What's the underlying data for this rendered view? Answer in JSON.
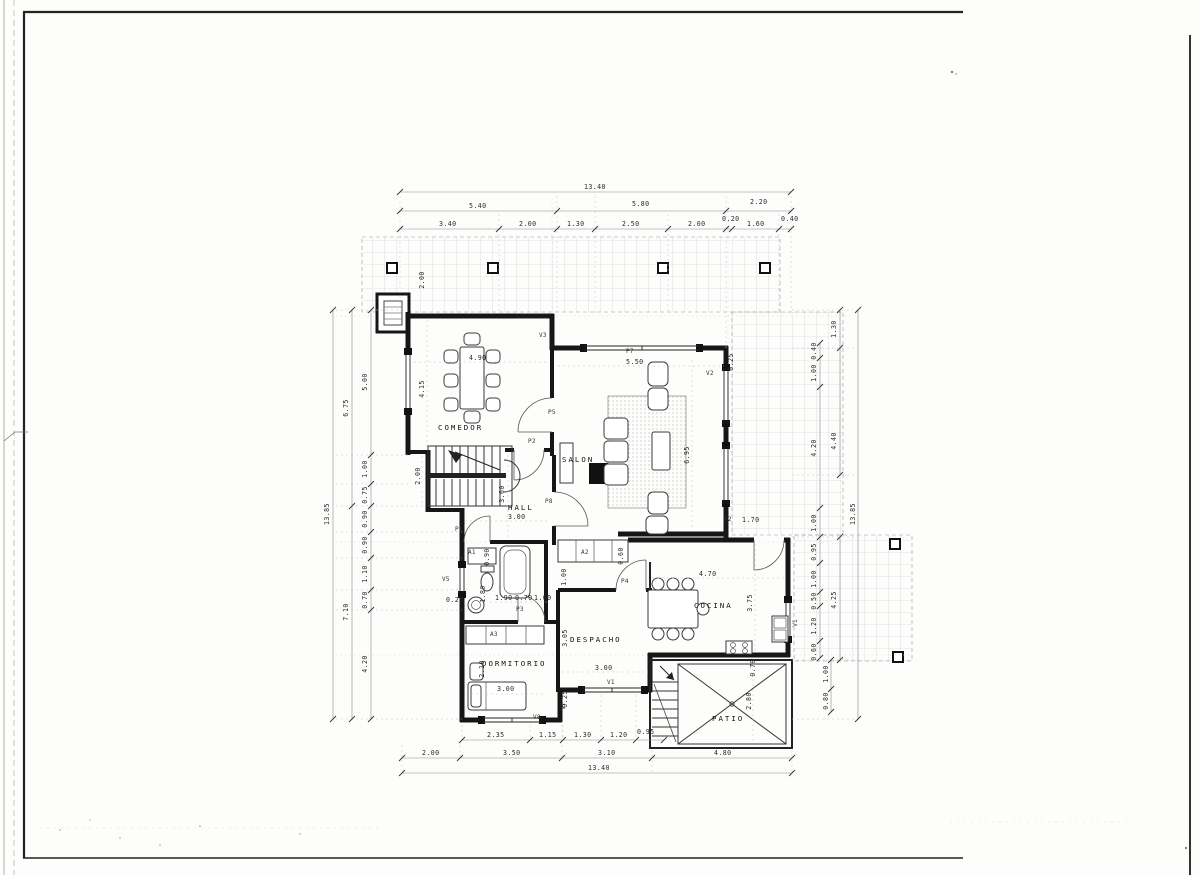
{
  "sheet": {
    "paper_color": "#fdfdfc",
    "ink_color": "#161616",
    "type_label": "floor-plan"
  },
  "plan": {
    "rooms": {
      "comedor": "COMEDOR",
      "salon": "SALON",
      "hall": "HALL",
      "dormitorio": "DORMITORIO",
      "despacho": "DESPACHO",
      "cocina": "COCINA",
      "patio": "PATIO"
    },
    "dims": {
      "top": {
        "overall": "13.40",
        "groups": [
          "5.40",
          "5.80",
          "2.20"
        ],
        "segments": [
          "3.40",
          "2.00",
          "1.30",
          "2.50",
          "2.00",
          "0.20",
          "1.60",
          "0.40"
        ]
      },
      "bottom": {
        "overall": "13.40",
        "groups": [
          "2.00",
          "3.50",
          "3.10",
          "4.80"
        ],
        "segments": [
          "2.35",
          "1.15",
          "1.30",
          "1.20",
          "0.95"
        ]
      },
      "left": {
        "overall": "13.85",
        "groups": [
          "6.75",
          "7.10"
        ],
        "segments": [
          "5.00",
          "1.00",
          "0.75",
          "0.90",
          "0.90",
          "1.10",
          "0.70",
          "4.20"
        ]
      },
      "right": {
        "overall": "13.85",
        "groups_upper": [
          "1.30",
          "4.40"
        ],
        "group_lower": "4.25",
        "segments": [
          "0.40",
          "1.00",
          "4.20",
          "1.00",
          "0.95",
          "1.00",
          "0.50",
          "1.20",
          "0.60"
        ],
        "below": [
          "1.00",
          "0.80"
        ]
      }
    },
    "interior": {
      "comedor_width": "4.90",
      "comedor_depth": "4.15",
      "stair_width": "2.00",
      "porch_depth": "2.00",
      "hall_width": "3.00",
      "hall_depth": "3.60",
      "closet_a1_depth": "0.90",
      "bath_length": "1.80",
      "bath_seg1": "1.90",
      "bath_seg2": "0.70",
      "bath_seg3": "1.00",
      "wall_thickness": "0.25",
      "dorm_side": "2.10",
      "bed_length": "3.00",
      "despacho_width": "3.00",
      "despacho_depth": "3.05",
      "corridor_width": "1.00",
      "closet_a2_depth": "0.60",
      "salon_width": "5.50",
      "salon_depth": "6.95",
      "salon_window": "1.70",
      "cocina_width": "4.70",
      "cocina_depth": "3.75",
      "patio_depth": "2.80",
      "patio_step": "0.70"
    },
    "openings": {
      "p1": "P1",
      "p2": "P2",
      "p3": "P3",
      "p4": "P4",
      "p5": "P5",
      "p7": "P7",
      "p8": "P8",
      "v1": "V1",
      "v2": "V2",
      "v3": "V3",
      "v5": "V5",
      "v7": "V7",
      "v8": "V8",
      "a1": "A1",
      "a2": "A2",
      "a3": "A3"
    }
  }
}
